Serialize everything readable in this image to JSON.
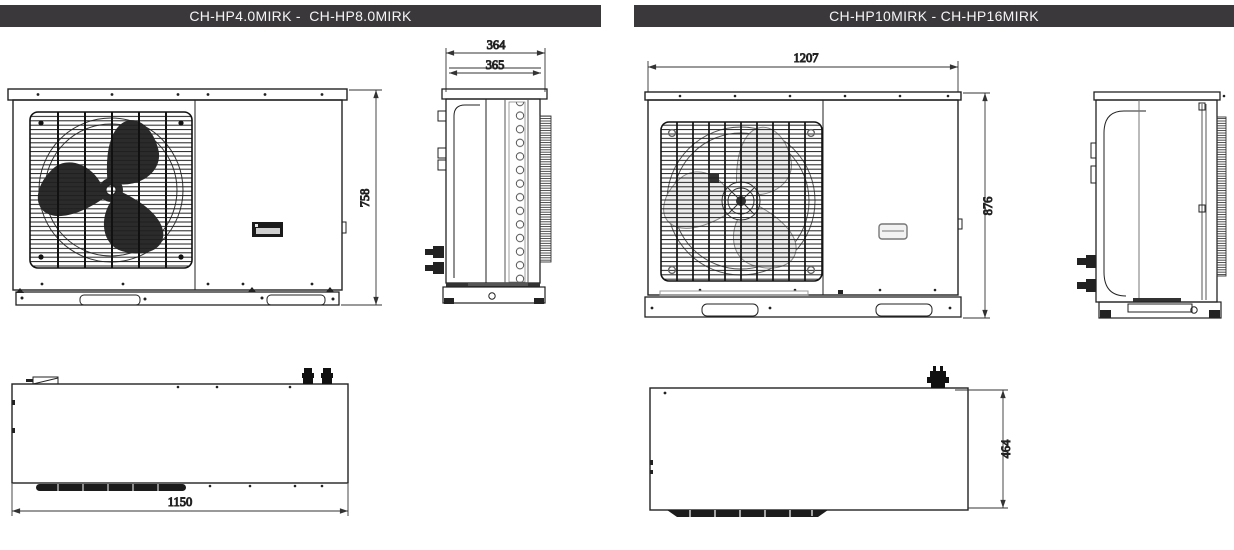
{
  "left_panel": {
    "title": "CH-HP4.0MIRK -  CH-HP8.0MIRK",
    "front_view": {
      "height_mm": "758"
    },
    "side_view": {
      "depth_outer_mm": "364",
      "depth_inner_mm": "365"
    },
    "top_view": {
      "width_mm": "1150"
    }
  },
  "right_panel": {
    "title": "CH-HP10MIRK - CH-HP16MIRK",
    "front_view": {
      "width_mm": "1207",
      "height_mm": "876"
    },
    "top_view": {
      "depth_mm": "464"
    }
  },
  "colors": {
    "header_bg": "#3b383c",
    "header_text": "#f5f5f5",
    "line_color": "#222222",
    "background": "#ffffff"
  }
}
